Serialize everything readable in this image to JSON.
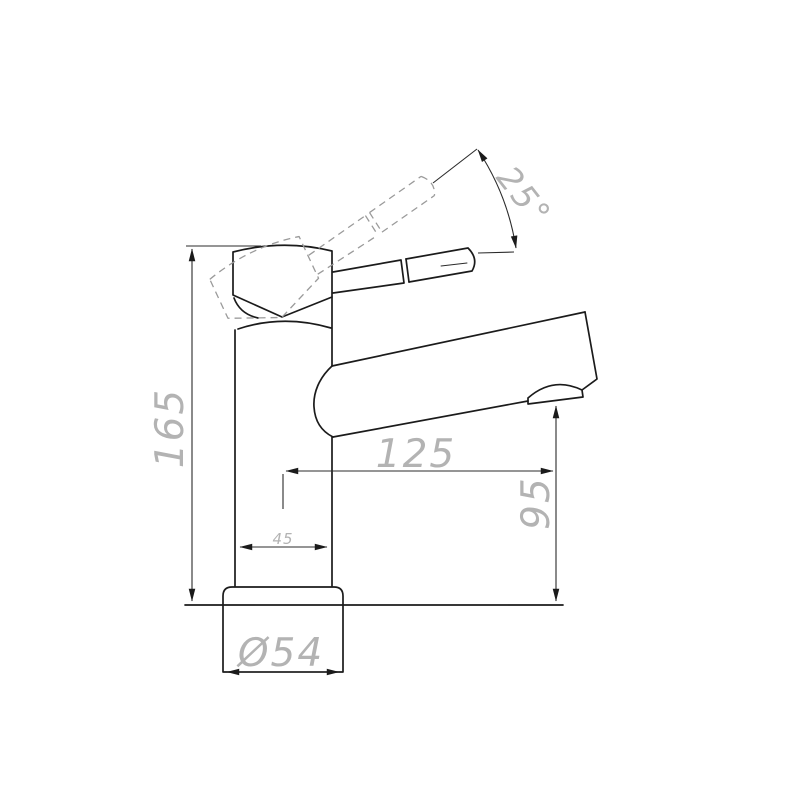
{
  "drawing": {
    "dimensions": {
      "overall_height": "165",
      "spout_reach": "125",
      "outlet_height": "95",
      "body_width": "45",
      "base_diameter": "Ø54",
      "lever_angle": "25°"
    },
    "colors": {
      "outline": "#1b1b1b",
      "raised_lever_dash": "#9a9a9a",
      "dimension_line": "#2b2b2b",
      "dimension_text": "#b3b3b3",
      "background": "#ffffff"
    }
  }
}
